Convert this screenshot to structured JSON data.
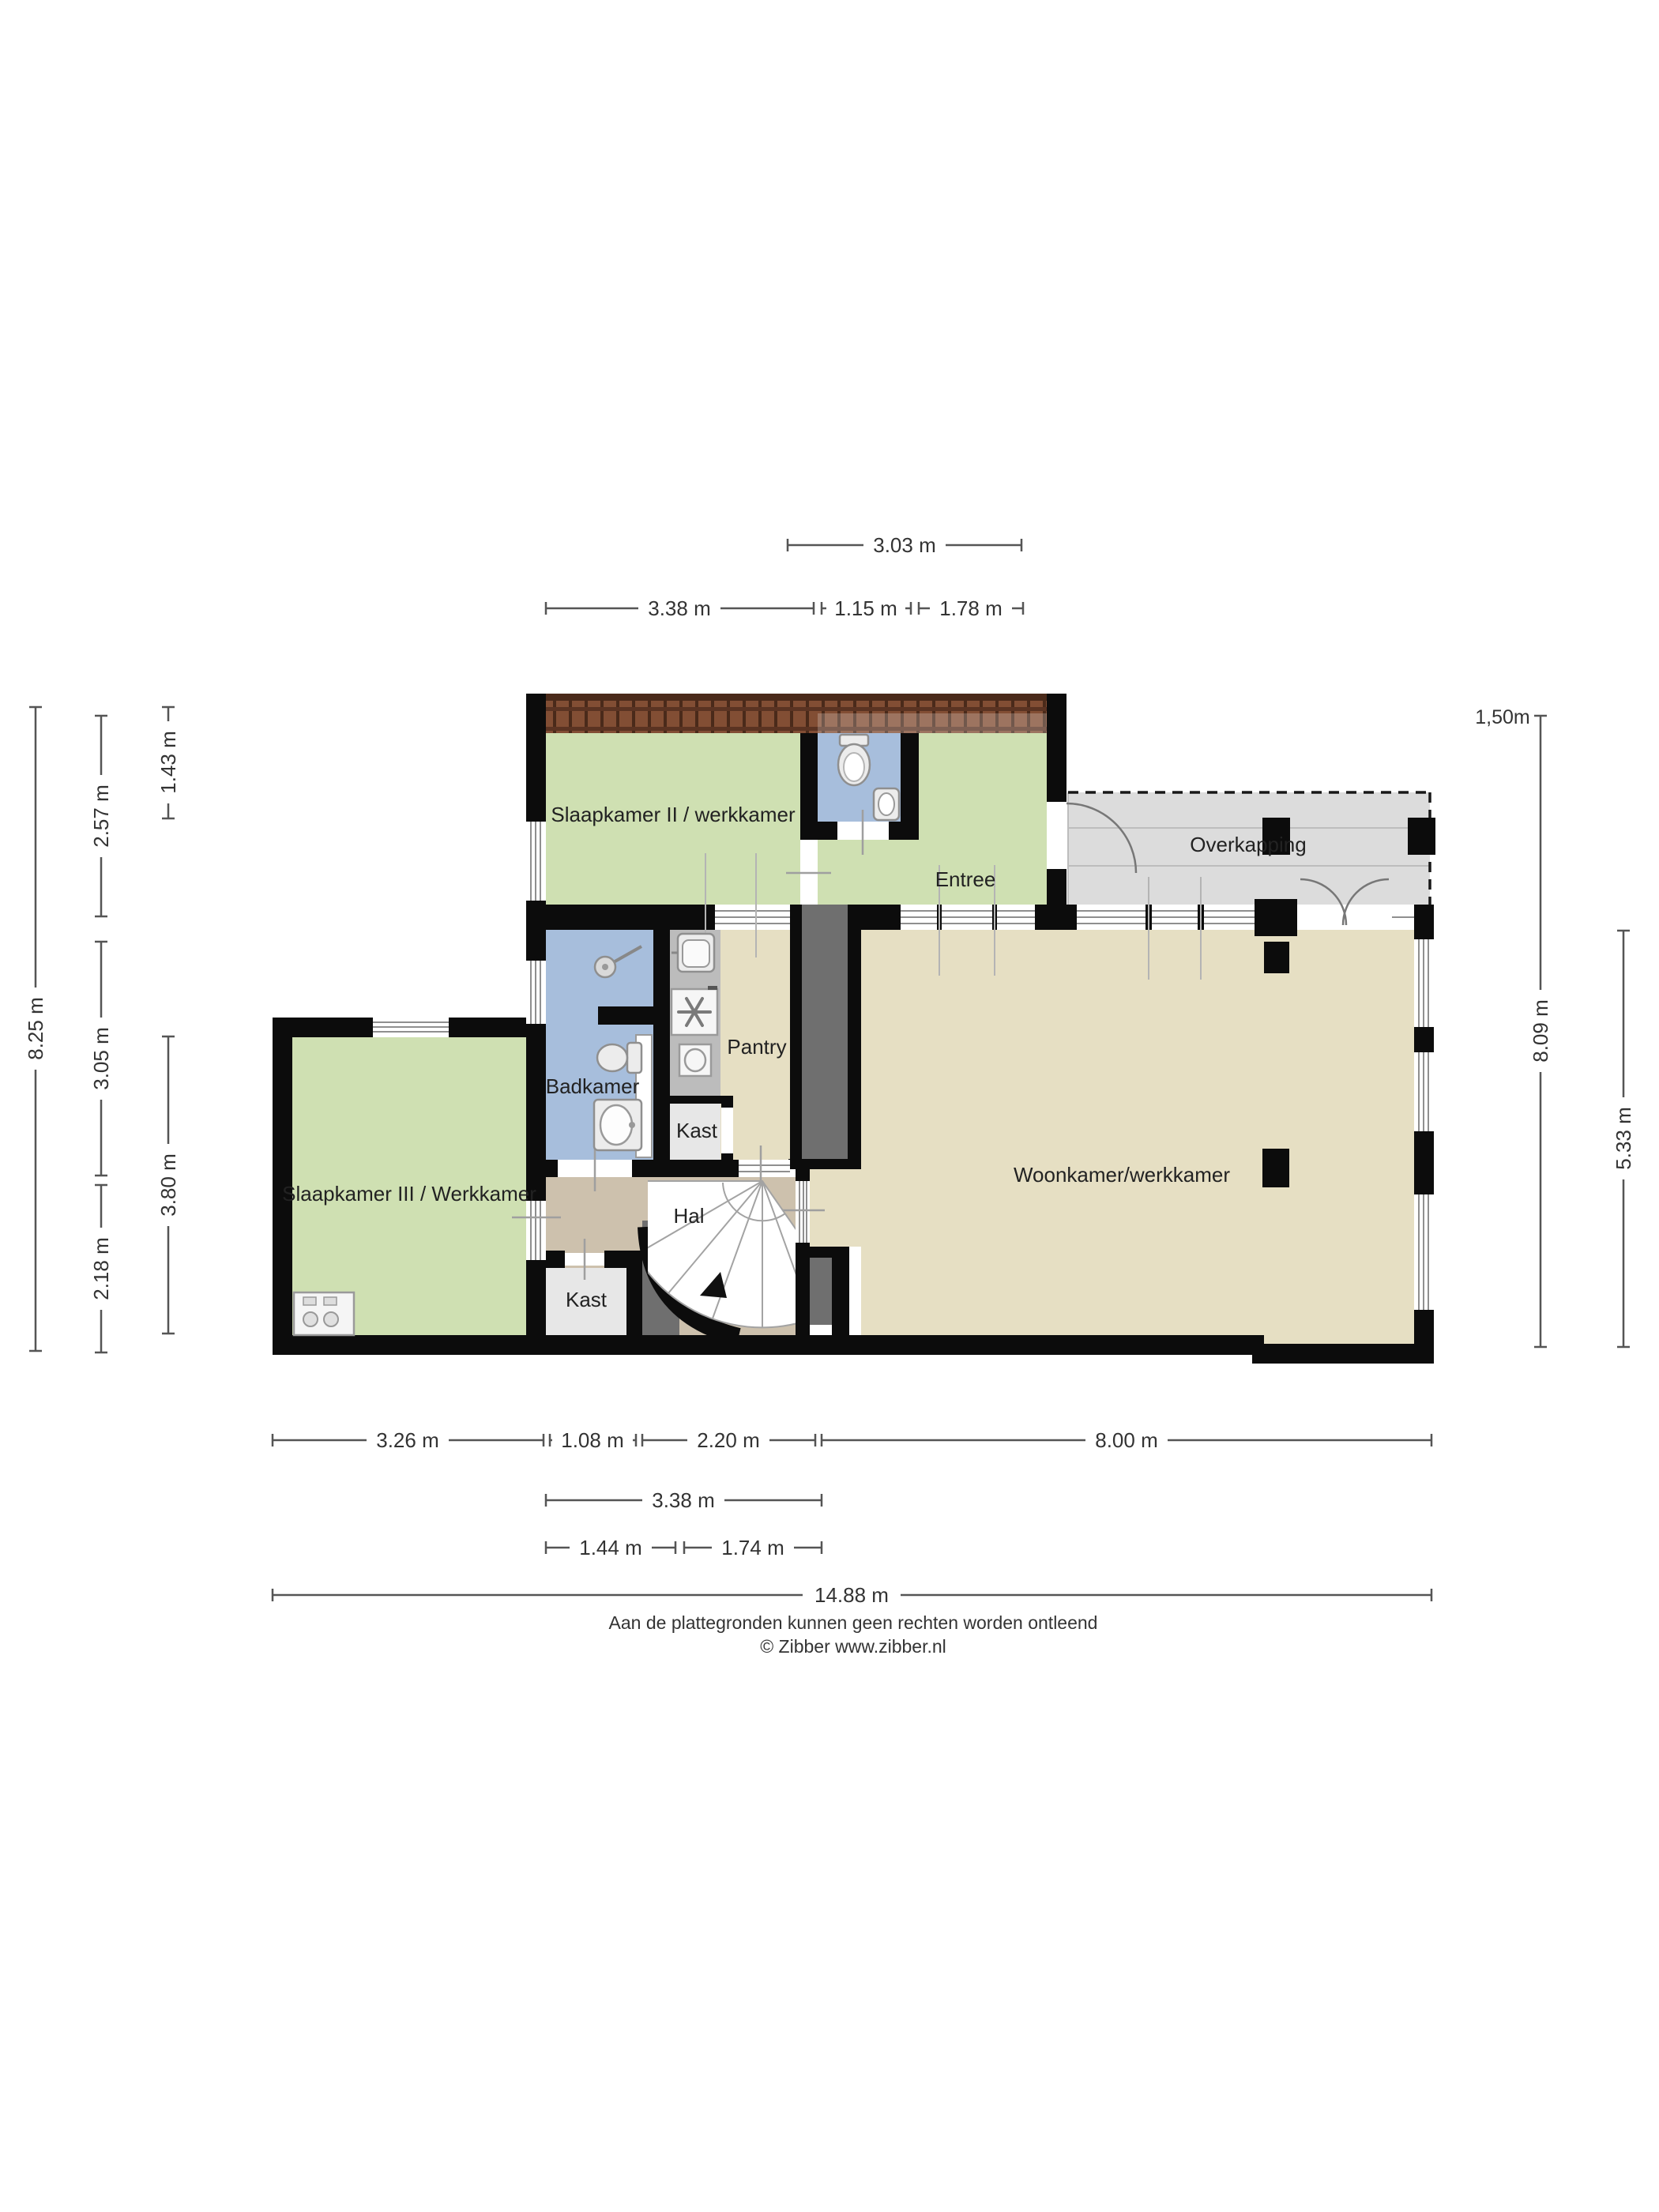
{
  "rooms": {
    "slaapkamer2": {
      "label": "Slaapkamer II / werkkamer"
    },
    "entree": {
      "label": "Entree"
    },
    "overkapping": {
      "label": "Overkapping"
    },
    "badkamer": {
      "label": "Badkamer"
    },
    "pantry": {
      "label": "Pantry"
    },
    "kast_pantry": {
      "label": "Kast"
    },
    "slaapkamer3": {
      "label": "Slaapkamer III / Werkkamer"
    },
    "hal": {
      "label": "Hal"
    },
    "kast_hal": {
      "label": "Kast"
    },
    "woonkamer": {
      "label": "Woonkamer/werkkamer"
    }
  },
  "dimensions": {
    "top_row1": [
      "3.03 m"
    ],
    "top_row2": [
      "3.38 m",
      "1.15 m",
      "1.78 m"
    ],
    "left_col1": [
      "8.25 m"
    ],
    "left_col2": [
      "2.57 m",
      "3.05 m",
      "2.18 m"
    ],
    "left_col3": [
      "1.43 m",
      "3.80 m"
    ],
    "right_note": "1,50m",
    "right_col1": [
      "8.09 m"
    ],
    "right_col2": [
      "5.33 m"
    ],
    "bottom_row1": [
      "3.26 m",
      "1.08 m",
      "2.20 m",
      "8.00 m"
    ],
    "bottom_row2": [
      "3.38 m"
    ],
    "bottom_row3": [
      "1.44 m",
      "1.74 m"
    ],
    "bottom_row4": [
      "14.88 m"
    ]
  },
  "footer": {
    "disclaimer": "Aan de plattegronden kunnen geen rechten worden ontleend",
    "copyright": "© Zibber www.zibber.nl"
  },
  "colors": {
    "room_green": "#cfe0b2",
    "room_blue": "#a7bedc",
    "room_beige": "#e6dfc3",
    "room_tan": "#cdc1ad",
    "overkapping_gray": "#dcdcdc",
    "closet_gray": "#e7e7e7",
    "corridor_gray": "#6f6f6f",
    "counter_gray": "#bcbcbc",
    "wall_black": "#0c0c0c",
    "roof_brown": "#824e34",
    "roof_joint": "#4a2a1a",
    "dim_line": "#555555"
  }
}
